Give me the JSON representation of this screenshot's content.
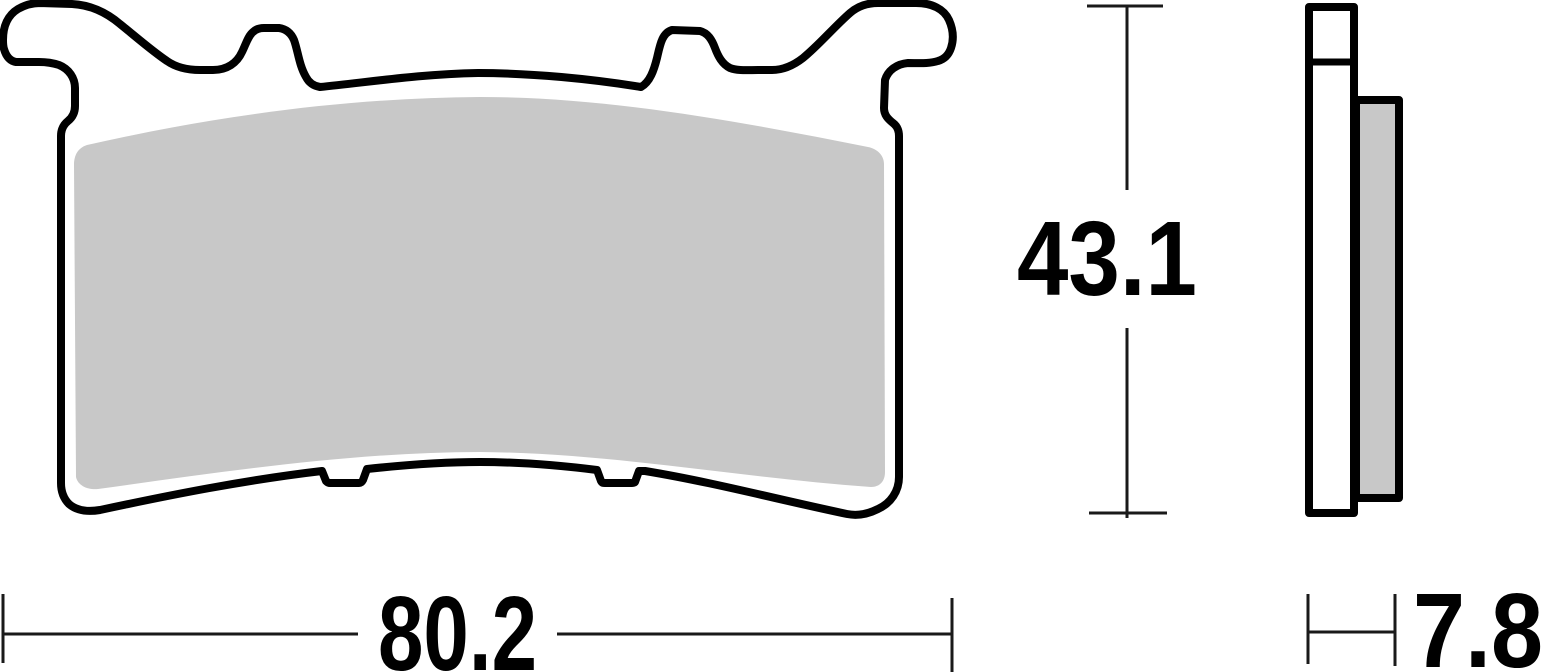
{
  "drawing": {
    "type": "technical-dimension-drawing",
    "subject": "brake-pad",
    "dimensions": {
      "width": {
        "label": "80.2"
      },
      "height": {
        "label": "43.1"
      },
      "thickness": {
        "label": "7.8"
      }
    },
    "colors": {
      "outline": "#000000",
      "friction_material_fill": "#c8c8c8",
      "backplate_fill": "#ffffff",
      "background": "#ffffff"
    }
  }
}
